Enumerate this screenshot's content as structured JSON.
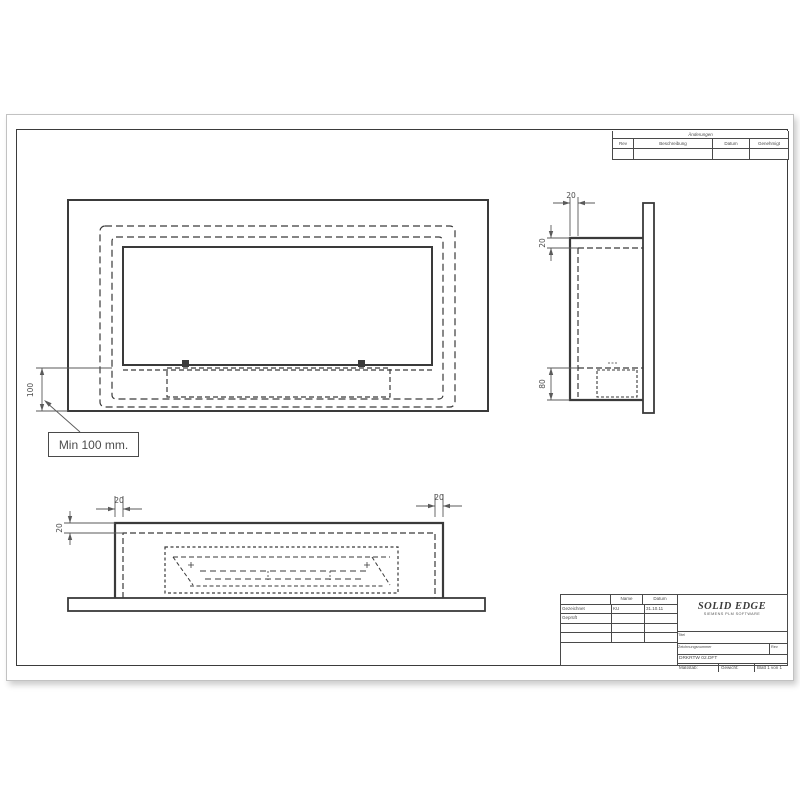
{
  "revision_table": {
    "title": "Änderungen",
    "columns": [
      "Rev",
      "Beschreibung",
      "Datum",
      "Genehmigt"
    ]
  },
  "title_block": {
    "approval": {
      "col_headers": [
        "Name",
        "Datum"
      ],
      "rows": [
        {
          "label": "Gezeichnet",
          "name": "KU",
          "date": "31.10.11"
        },
        {
          "label": "Geprüft",
          "name": "",
          "date": ""
        }
      ]
    },
    "brand_line1": "SOLID EDGE",
    "brand_line2": "SIEMENS PLM SOFTWARE",
    "titel_label": "Titel",
    "number_label": "Zeichnungsnummer",
    "rev_label": "Rev",
    "filename": "DRKRTW 02.DFT",
    "scale_label": "Maßstab:",
    "weight_label": "Gewicht:",
    "sheet_label": "Blatt 1 von 1"
  },
  "callout": {
    "text": "Min 100 mm."
  },
  "dimensions": {
    "front_height": "100",
    "side_depth": "20",
    "side_top": "20",
    "side_bottom": "80",
    "bottom_left": "20",
    "bottom_right": "20",
    "bottom_height": "20"
  }
}
